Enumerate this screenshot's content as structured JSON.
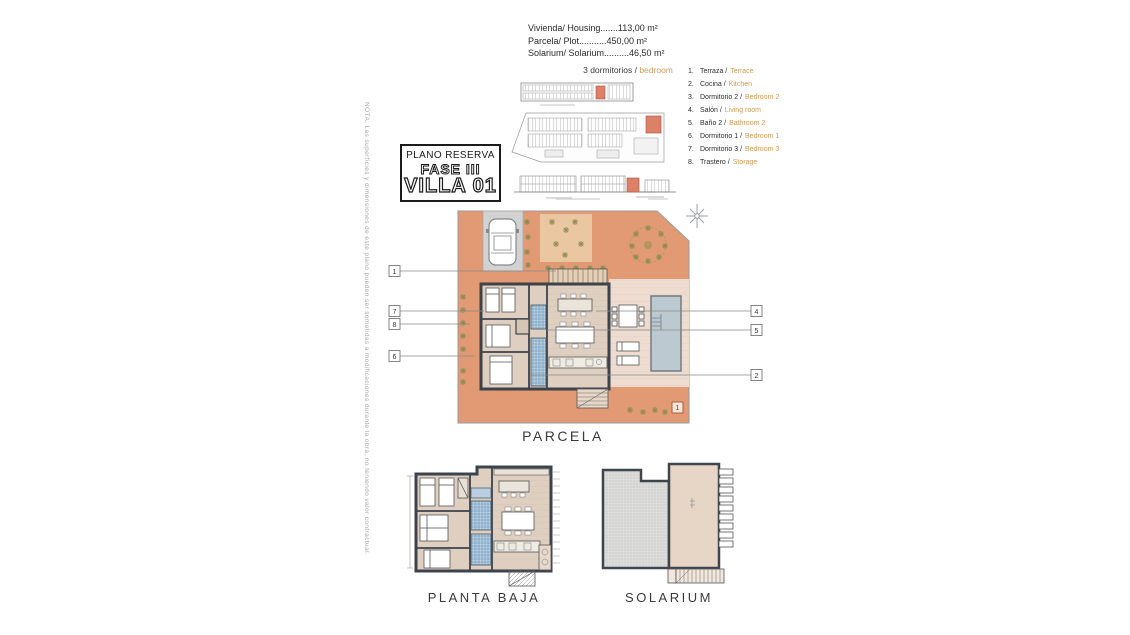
{
  "note": "NOTA: Las superficies y dimensiones de este plano pueden ser sometidas a modificaciones durante la obra, no teniendo valor contractual.",
  "header": {
    "line1": "Vivienda/ Housing.......113,00 m²",
    "line2": "Parcela/ Plot...........450,00 m²",
    "line3": "Solarium/ Solarium..........46,50 m²"
  },
  "bedrooms": {
    "es": "3 dormitorios / ",
    "en": "bedroom"
  },
  "reserva": {
    "line1": "PLANO RESERVA",
    "line2": "FASE III",
    "line3": "VILLA 01"
  },
  "legend": {
    "items": [
      {
        "num": "1.",
        "es": "Terraza / ",
        "en": "Terrace"
      },
      {
        "num": "2.",
        "es": "Cocina / ",
        "en": "Kitchen"
      },
      {
        "num": "3.",
        "es": "Dormitorio 2 / ",
        "en": "Bedroom 2"
      },
      {
        "num": "4.",
        "es": "Salón / ",
        "en": "Living room"
      },
      {
        "num": "5.",
        "es": "Baño 2 / ",
        "en": "Bathroom 2"
      },
      {
        "num": "6.",
        "es": "Dormitorio 1 / ",
        "en": "Bedroom 1"
      },
      {
        "num": "7.",
        "es": "Dormitorio 3 / ",
        "en": "Bedroom 3"
      },
      {
        "num": "8.",
        "es": "Trastero / ",
        "en": "Storage"
      }
    ]
  },
  "plans": {
    "parcela": "PARCELA",
    "planta_baja": "PLANTA BAJA",
    "solarium": "SOLARIUM"
  },
  "callouts": {
    "c1": "1",
    "c7": "7",
    "c8": "8",
    "c6": "6",
    "c4": "4",
    "c5": "5",
    "c2": "2",
    "c1b": "1"
  },
  "colors": {
    "terrace_terracotta": "#e19a73",
    "patio_beige": "#eddccf",
    "floor_beige": "#decfc0",
    "wall_dark": "#3d434b",
    "pool_blue": "#bdc9d1",
    "bath_tile_blue": "#8fb2cd",
    "highlight_red": "#dd8068",
    "accent_text_orange": "#cf9a55",
    "driveway_gray": "#d2d2d2"
  }
}
